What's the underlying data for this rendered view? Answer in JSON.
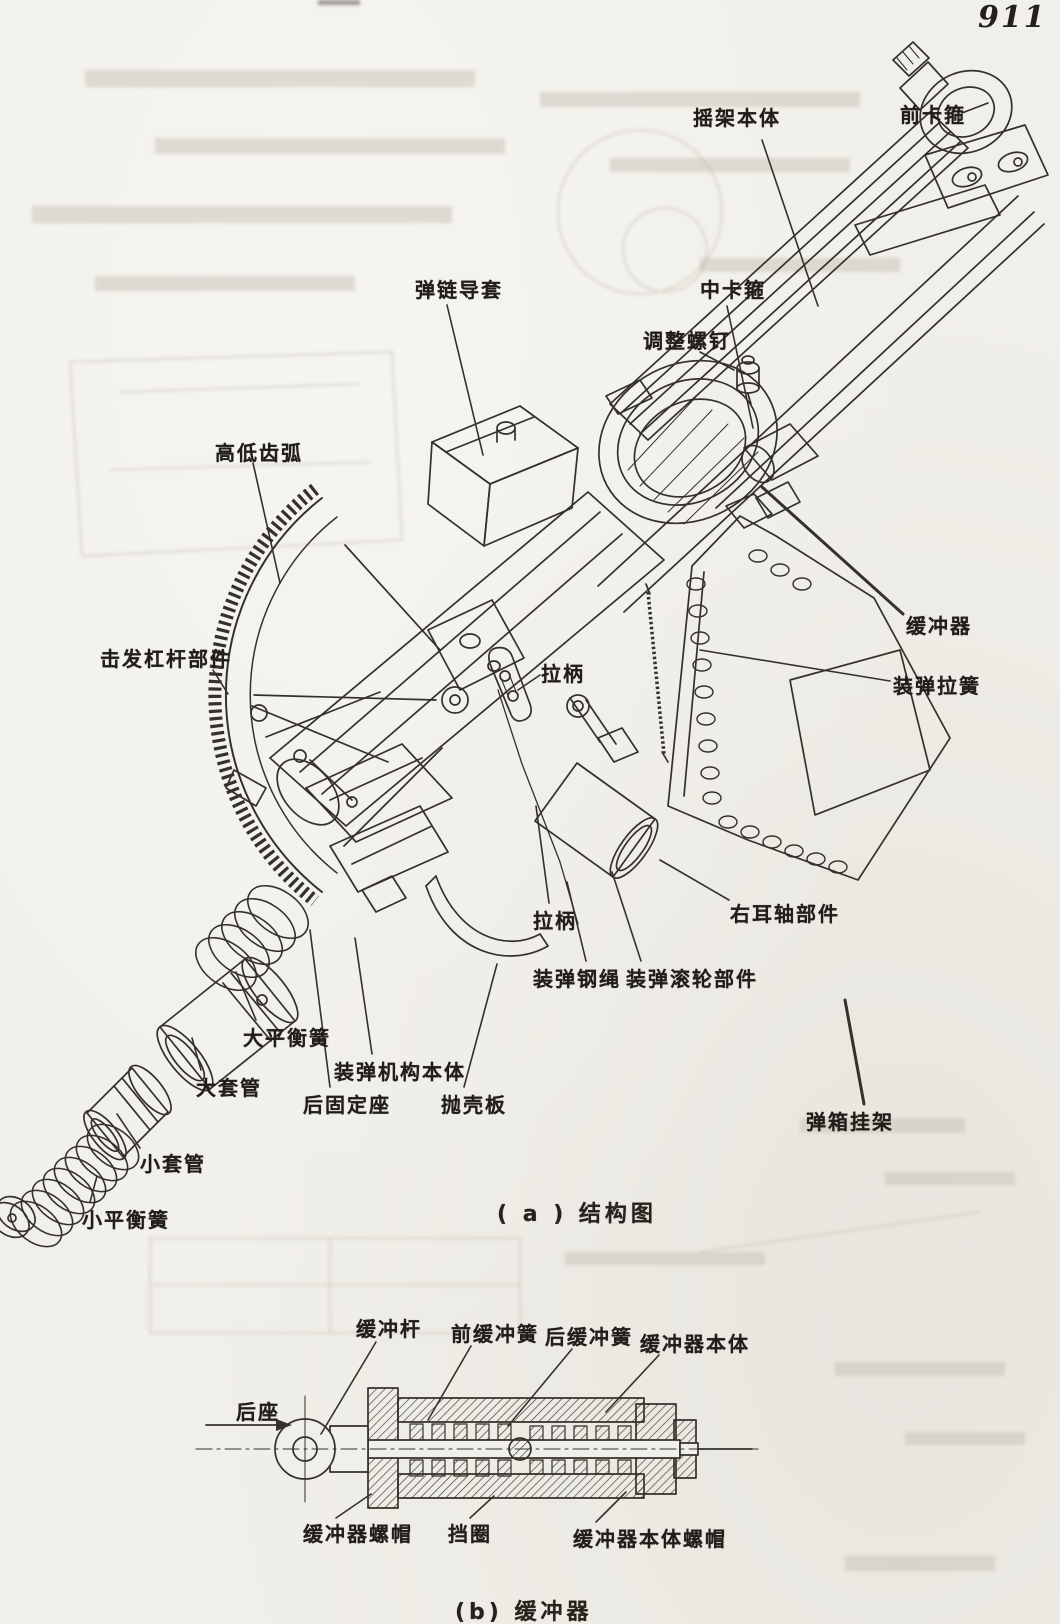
{
  "page": {
    "number": "911"
  },
  "colors": {
    "paper": "#f1efe9",
    "ink": "#34312b",
    "ghost": "#c3bcae"
  },
  "figure_a": {
    "caption": "( a ) 结构图",
    "caption_pos": {
      "x": 497,
      "y": 1196
    },
    "labels": [
      {
        "text": "摇架本体",
        "x": 693,
        "y": 102,
        "leader": [
          762,
          140,
          818,
          306
        ]
      },
      {
        "text": "前卡箍",
        "x": 900,
        "y": 99,
        "leader": [
          962,
          113,
          988,
          103
        ]
      },
      {
        "text": "弹链导套",
        "x": 415,
        "y": 274,
        "leader": [
          447,
          305,
          483,
          455
        ]
      },
      {
        "text": "中卡箍",
        "x": 700,
        "y": 274,
        "leader": [
          727,
          306,
          753,
          428
        ]
      },
      {
        "text": "调整螺钉",
        "x": 643,
        "y": 325,
        "leader": [
          700,
          352,
          734,
          370
        ]
      },
      {
        "text": "高低齿弧",
        "x": 215,
        "y": 437,
        "leader": [
          253,
          463,
          280,
          583
        ]
      },
      {
        "text": "击发杠杆部件",
        "x": 100,
        "y": 643,
        "leader": [
          213,
          670,
          228,
          694
        ]
      },
      {
        "text": "拉柄",
        "x": 541,
        "y": 658,
        "leader": [
          540,
          675,
          518,
          690
        ]
      },
      {
        "text": "缓冲器",
        "x": 906,
        "y": 610,
        "leader": [
          762,
          487,
          903,
          614
        ],
        "leader_width": 3
      },
      {
        "text": "装弹拉簧",
        "x": 893,
        "y": 670,
        "leader": [
          700,
          650,
          890,
          681
        ]
      },
      {
        "text": "拉柄",
        "x": 533,
        "y": 905,
        "leader": [
          536,
          806,
          549,
          903
        ]
      },
      {
        "text": "右耳轴部件",
        "x": 730,
        "y": 898,
        "leader": [
          660,
          860,
          729,
          900
        ]
      },
      {
        "text": "装弹钢绳",
        "x": 533,
        "y": 963,
        "leader": [
          567,
          882,
          586,
          961
        ]
      },
      {
        "text": "装弹滚轮部件",
        "x": 626,
        "y": 963,
        "leader": [
          612,
          872,
          641,
          961
        ]
      },
      {
        "text": "大平衡簧",
        "x": 243,
        "y": 1022,
        "leader": [
          236,
          972,
          256,
          1020
        ]
      },
      {
        "text": "大套管",
        "x": 196,
        "y": 1072,
        "leader": [
          192,
          1038,
          201,
          1070
        ]
      },
      {
        "text": "小套管",
        "x": 140,
        "y": 1148,
        "leader": [
          117,
          1114,
          140,
          1148
        ]
      },
      {
        "text": "小平衡簧",
        "x": 82,
        "y": 1204,
        "leader": [
          97,
          1176,
          90,
          1202
        ]
      },
      {
        "text": "装弹机构本体",
        "x": 334,
        "y": 1056,
        "leader": [
          355,
          938,
          372,
          1054
        ]
      },
      {
        "text": "后固定座",
        "x": 303,
        "y": 1089,
        "leader": [
          310,
          930,
          330,
          1087
        ]
      },
      {
        "text": "抛壳板",
        "x": 441,
        "y": 1089,
        "leader": [
          497,
          964,
          464,
          1087
        ]
      },
      {
        "text": "弹箱挂架",
        "x": 806,
        "y": 1106,
        "leader": [
          845,
          1000,
          864,
          1104
        ],
        "leader_width": 3
      }
    ]
  },
  "figure_b": {
    "caption": "(b) 缓冲器",
    "caption_pos": {
      "x": 455,
      "y": 1594
    },
    "labels": [
      {
        "text": "缓冲杆",
        "x": 356,
        "y": 1313,
        "leader": [
          376,
          1342,
          321,
          1434
        ]
      },
      {
        "text": "前缓冲簧",
        "x": 451,
        "y": 1318,
        "leader": [
          471,
          1346,
          428,
          1420
        ]
      },
      {
        "text": "后缓冲簧",
        "x": 545,
        "y": 1321,
        "leader": [
          572,
          1349,
          508,
          1426
        ]
      },
      {
        "text": "缓冲器本体",
        "x": 640,
        "y": 1328,
        "leader": [
          659,
          1355,
          606,
          1412
        ]
      },
      {
        "text": "后座",
        "x": 236,
        "y": 1396
      },
      {
        "text": "缓冲器螺帽",
        "x": 303,
        "y": 1518,
        "leader": [
          371,
          1494,
          336,
          1518
        ]
      },
      {
        "text": "挡圈",
        "x": 448,
        "y": 1518,
        "leader": [
          494,
          1496,
          470,
          1518
        ]
      },
      {
        "text": "缓冲器本体螺帽",
        "x": 573,
        "y": 1523,
        "leader": [
          626,
          1492,
          596,
          1522
        ]
      }
    ]
  }
}
